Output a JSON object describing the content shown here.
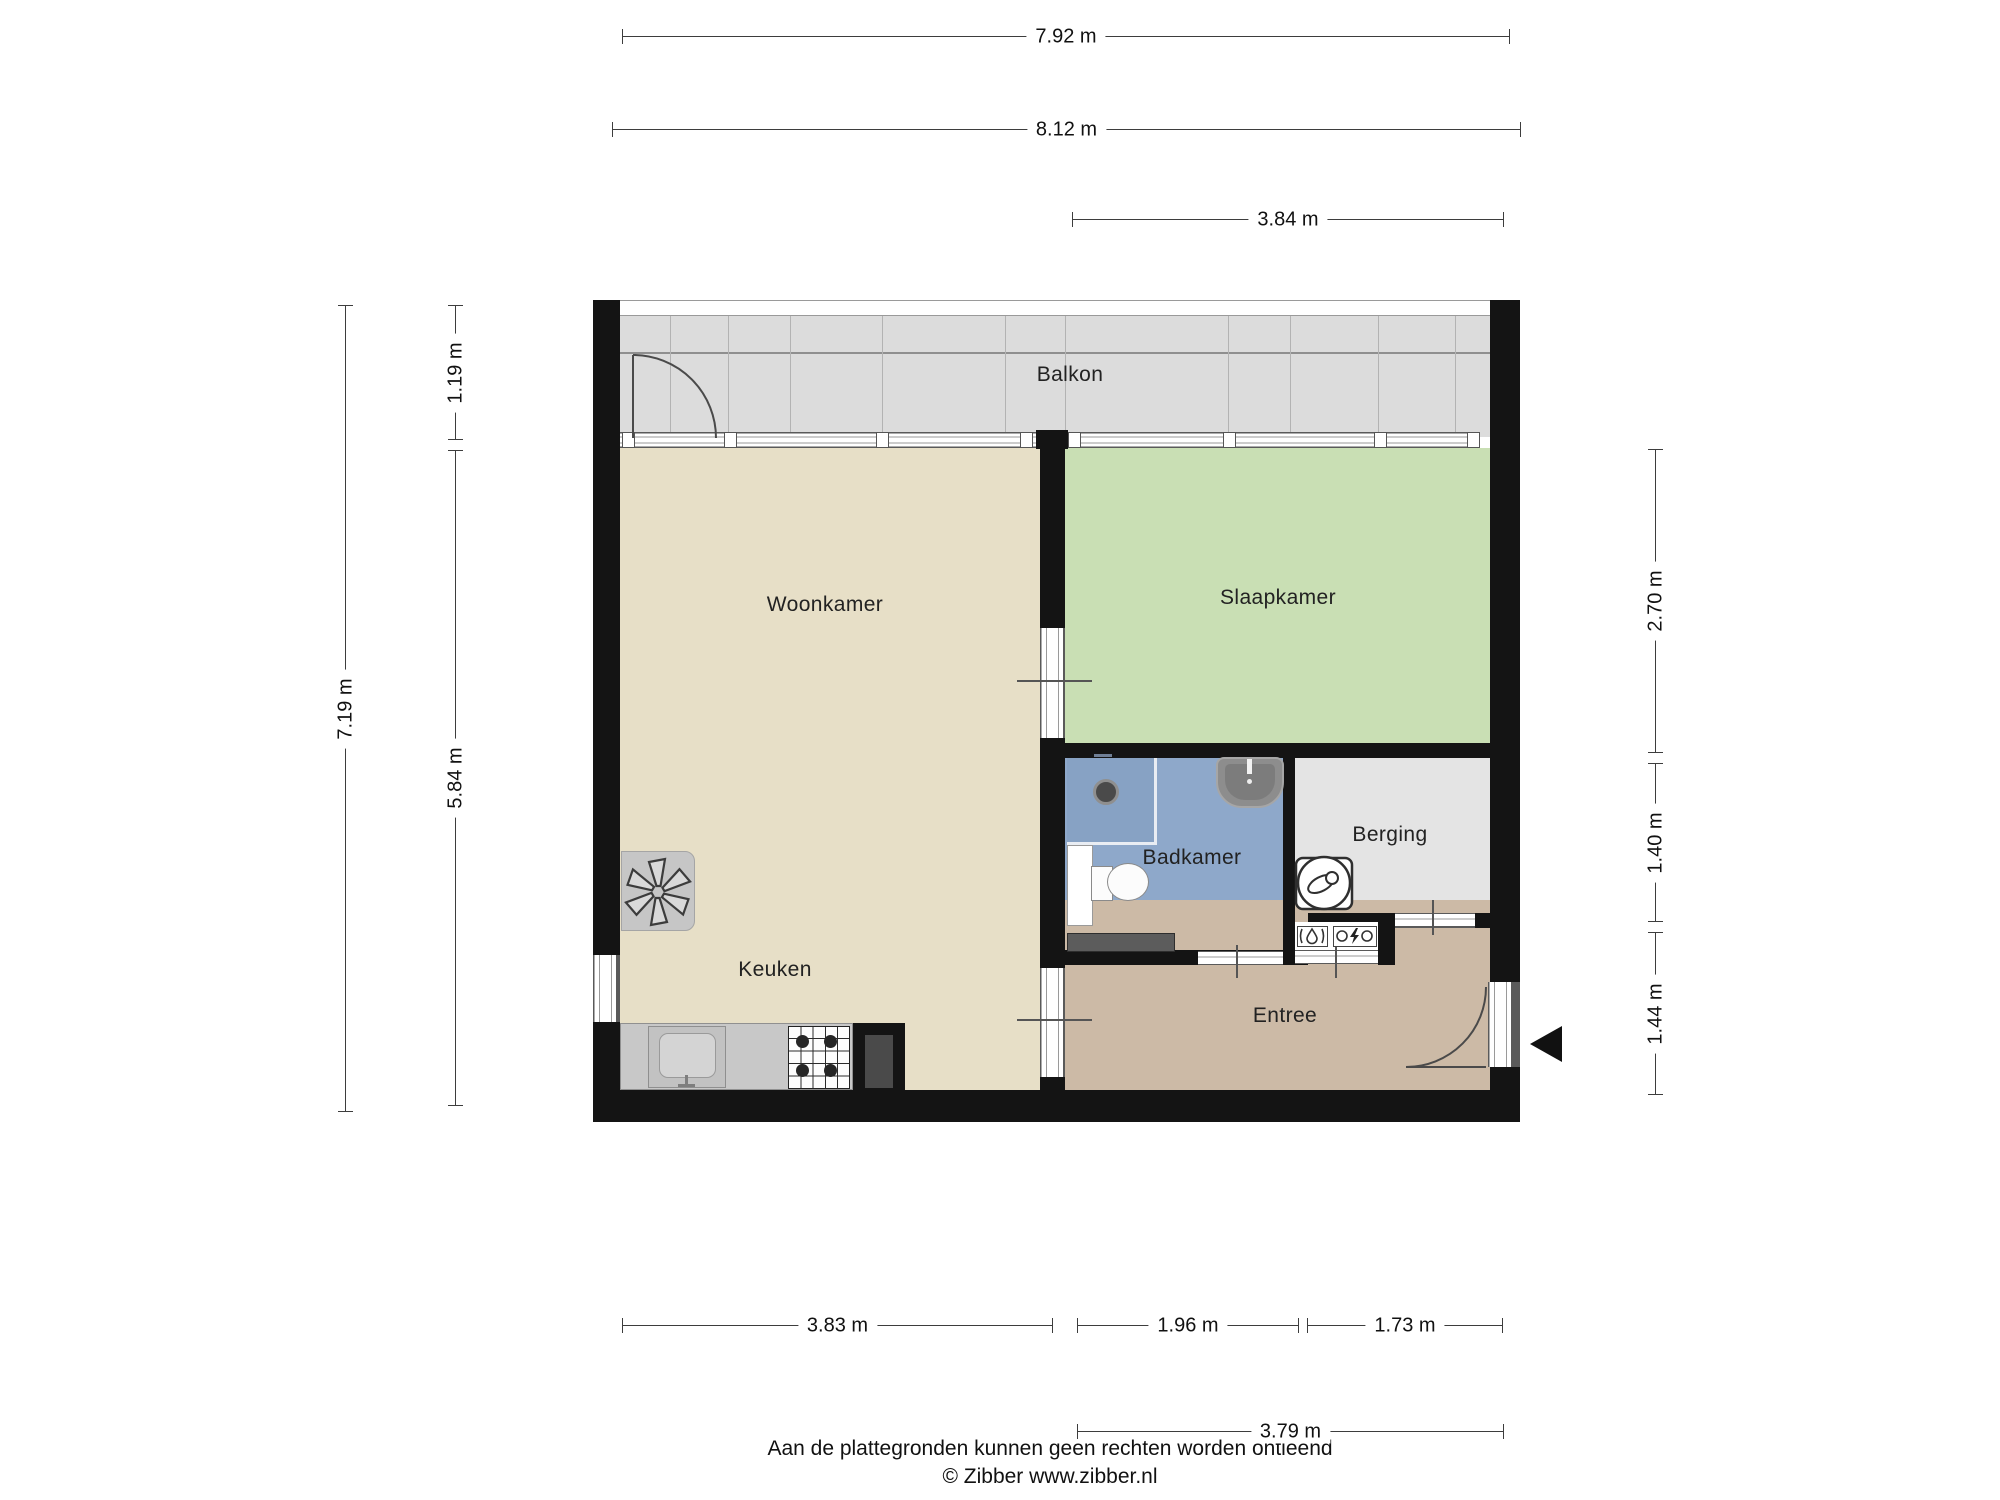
{
  "plan": {
    "rooms": [
      {
        "id": "balkon",
        "label": "Balkon"
      },
      {
        "id": "woonkamer",
        "label": "Woonkamer"
      },
      {
        "id": "slaapkamer",
        "label": "Slaapkamer"
      },
      {
        "id": "badkamer",
        "label": "Badkamer"
      },
      {
        "id": "berging",
        "label": "Berging"
      },
      {
        "id": "keuken",
        "label": "Keuken"
      },
      {
        "id": "entree",
        "label": "Entree"
      }
    ]
  },
  "dimensions": {
    "top": [
      {
        "label": "7.92 m"
      },
      {
        "label": "8.12 m"
      },
      {
        "label": "3.84 m"
      }
    ],
    "bottom": [
      {
        "label": "3.83 m"
      },
      {
        "label": "1.96 m"
      },
      {
        "label": "1.73 m"
      },
      {
        "label": "3.79 m"
      }
    ],
    "left": [
      {
        "label": "7.19 m"
      },
      {
        "label": "1.19 m"
      },
      {
        "label": "5.84 m"
      }
    ],
    "right": [
      {
        "label": "2.70 m"
      },
      {
        "label": "1.40 m"
      },
      {
        "label": "1.44 m"
      }
    ]
  },
  "footer": {
    "disclaimer": "Aan de plattegronden kunnen geen rechten worden ontleend",
    "credit": "© Zibber www.zibber.nl"
  },
  "colors": {
    "wall": "#141414",
    "balkon_floor": "#dcdcdc",
    "woonkamer": "#e7dfc7",
    "slaapkamer": "#c9dfb4",
    "badkamer": "#8ea8ca",
    "shower": "#87a2c4",
    "berging": "#e4e4e4",
    "entree": "#ccbaa6",
    "counter": "#c8c8c8",
    "radiator": "#5c5c5c"
  }
}
